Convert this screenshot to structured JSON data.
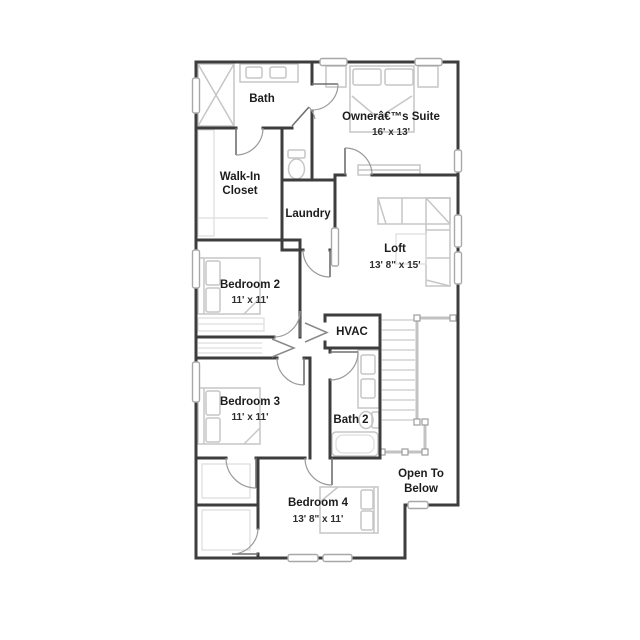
{
  "title": "Second Floor Plan",
  "colors": {
    "background": "#ffffff",
    "wall": "#3d3d3d",
    "furniture": "#c6c6c6",
    "railing": "#c2c2c2",
    "window_frame": "#a8a8a8",
    "door": "#9a9a9a",
    "text": "#1c1c1c"
  },
  "rooms": {
    "bath": {
      "name": "Bath"
    },
    "owners_suite": {
      "name": "Ownerâ€™s Suite",
      "dims": "16' x 13'"
    },
    "walk_in_closet": {
      "line1": "Walk-In",
      "line2": "Closet"
    },
    "laundry": {
      "name": "Laundry"
    },
    "loft": {
      "name": "Loft",
      "dims": "13' 8\" x 15'"
    },
    "bedroom2": {
      "name": "Bedroom 2",
      "dims": "11' x 11'"
    },
    "hvac": {
      "name": "HVAC"
    },
    "bedroom3": {
      "name": "Bedroom 3",
      "dims": "11' x 11'"
    },
    "bath2": {
      "name": "Bath 2"
    },
    "bedroom4": {
      "name": "Bedroom 4",
      "dims": "13' 8\" x 11'"
    },
    "open_to_below": {
      "line1": "Open To",
      "line2": "Below"
    }
  },
  "furniture_icons": [
    "shower",
    "vanity",
    "toilet",
    "bed",
    "nightstand",
    "dresser",
    "sofa",
    "coffee-table",
    "bathtub",
    "stairs",
    "railing",
    "closet-shelves",
    "linen-shelves"
  ]
}
